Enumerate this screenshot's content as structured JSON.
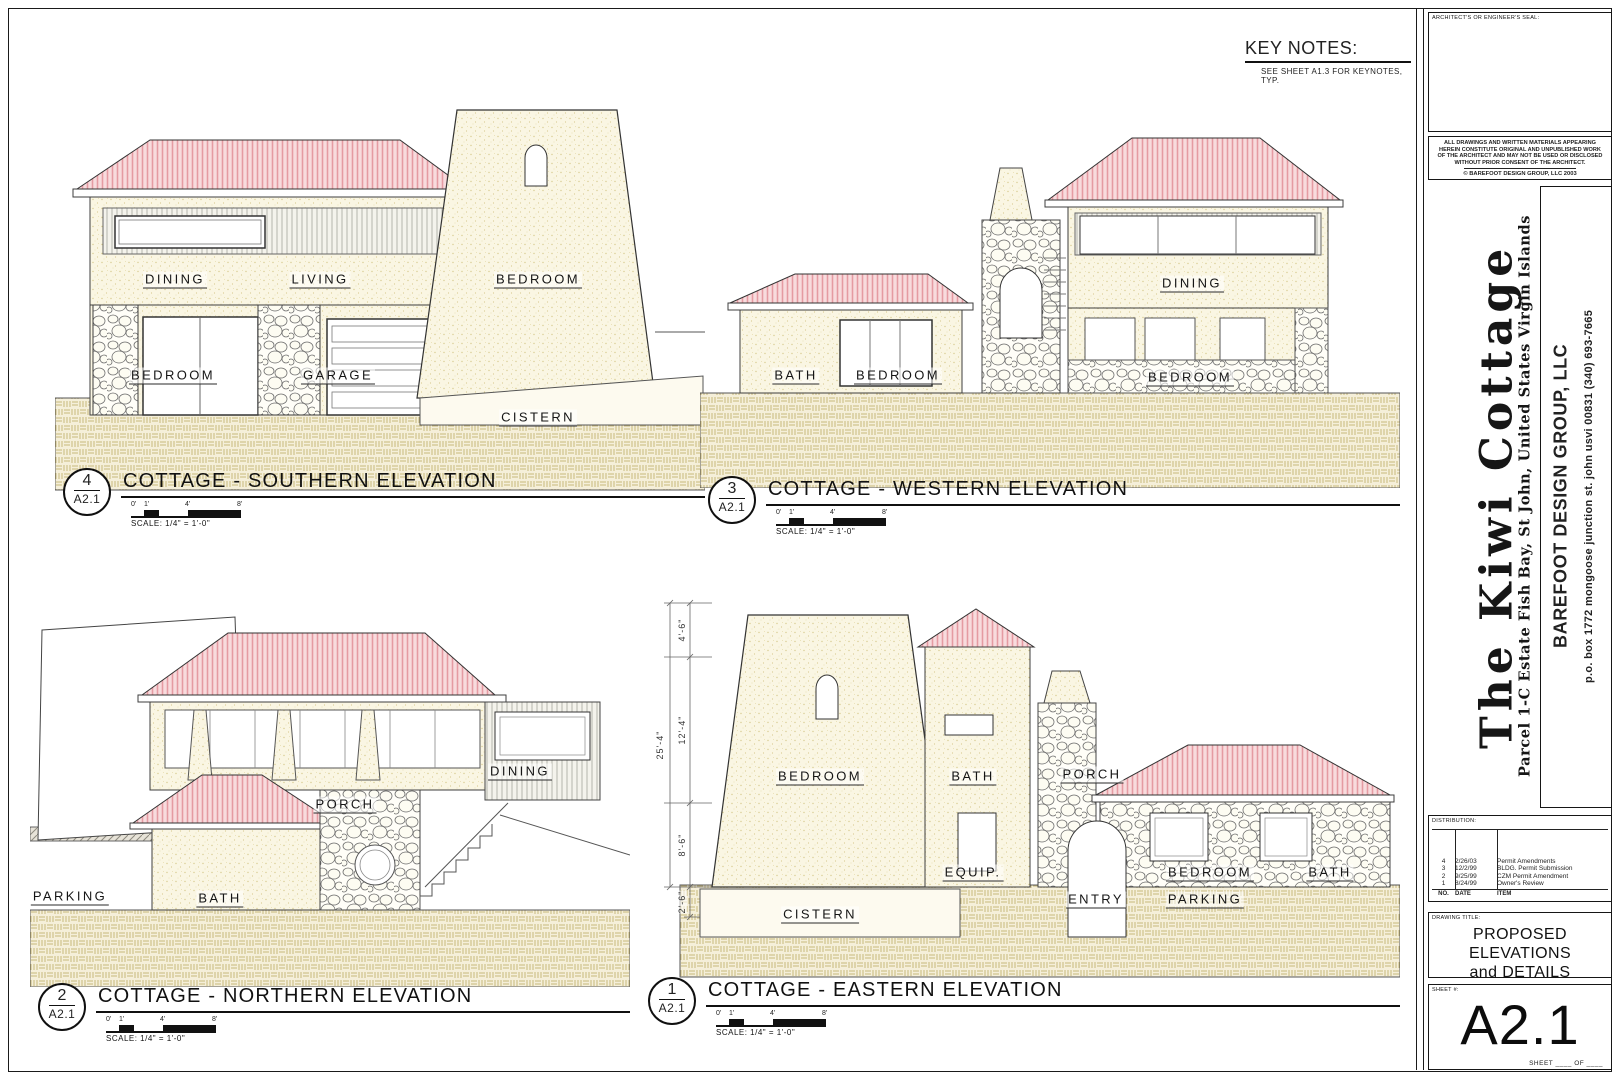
{
  "colors": {
    "roof_pink": "#e59ba2",
    "roof_fill": "#f8dbdd",
    "wall_cream": "#faf6e3",
    "ground_line": "#c8b87c",
    "ground_fill": "#f5efd9",
    "ink": "#333333"
  },
  "key_notes": {
    "title": "KEY NOTES:",
    "note": "SEE SHEET A1.3 FOR KEYNOTES, TYP."
  },
  "elevations": [
    {
      "number": "4",
      "sheet_ref": "A2.1",
      "title": "COTTAGE - SOUTHERN ELEVATION",
      "scale": "SCALE: 1/4\" = 1'-0\"",
      "ticks": [
        "0'",
        "1'",
        "4'",
        "8'"
      ],
      "rooms": [
        "DINING",
        "LIVING",
        "BEDROOM",
        "BEDROOM",
        "GARAGE",
        "CISTERN"
      ]
    },
    {
      "number": "3",
      "sheet_ref": "A2.1",
      "title": "COTTAGE - WESTERN ELEVATION",
      "scale": "SCALE: 1/4\" = 1'-0\"",
      "ticks": [
        "0'",
        "1'",
        "4'",
        "8'"
      ],
      "rooms": [
        "DINING",
        "BATH",
        "BEDROOM",
        "BEDROOM"
      ]
    },
    {
      "number": "2",
      "sheet_ref": "A2.1",
      "title": "COTTAGE - NORTHERN ELEVATION",
      "scale": "SCALE: 1/4\" = 1'-0\"",
      "ticks": [
        "0'",
        "1'",
        "4'",
        "8'"
      ],
      "rooms": [
        "PORCH",
        "DINING",
        "BATH",
        "PARKING"
      ]
    },
    {
      "number": "1",
      "sheet_ref": "A2.1",
      "title": "COTTAGE - EASTERN ELEVATION",
      "scale": "SCALE: 1/4\" = 1'-0\"",
      "ticks": [
        "0'",
        "1'",
        "4'",
        "8'"
      ],
      "rooms": [
        "BEDROOM",
        "BATH",
        "PORCH",
        "EQUIP.",
        "CISTERN",
        "ENTRY",
        "BEDROOM",
        "PARKING",
        "BATH"
      ],
      "dimensions": {
        "overall": "25'-4\"",
        "segments": [
          "4'-6\"",
          "12'-4\"",
          "8'-6\"",
          "2'-6\""
        ]
      }
    }
  ],
  "title_block": {
    "seal_label": "ARCHITECT'S OR ENGINEER'S SEAL:",
    "legal": "ALL DRAWINGS AND WRITTEN MATERIALS APPEARING HEREIN CONSTITUTE ORIGINAL AND UNPUBLISHED WORK OF THE ARCHITECT AND MAY NOT BE USED OR DISCLOSED WITHOUT PRIOR CONSENT OF THE ARCHITECT.",
    "copyright": "© BAREFOOT DESIGN GROUP, LLC 2003",
    "project_title": "The Kiwi Cottage",
    "project_location": "Parcel 1-C Estate Fish Bay, St John, United States Virgin Islands",
    "firm_name": "BAREFOOT DESIGN GROUP, LLC",
    "firm_address": "p.o. box 1772 mongoose junction st. john usvi 00831 (340) 693-7665",
    "distribution": {
      "label": "DISTRIBUTION:",
      "rows": [
        {
          "no": "4",
          "date": "2/26/03",
          "item": "Permit Amendments"
        },
        {
          "no": "3",
          "date": "12/2/99",
          "item": "BLDG. Permit Submission"
        },
        {
          "no": "2",
          "date": "9/25/99",
          "item": "CZM Permit Amendment"
        },
        {
          "no": "1",
          "date": "8/24/99",
          "item": "Owner's Review"
        }
      ],
      "footer": {
        "no": "NO.",
        "date": "DATE",
        "item": "ITEM"
      }
    },
    "drawing_title_label": "DRAWING TITLE:",
    "drawing_title": "PROPOSED ELEVATIONS and DETAILS",
    "sheet_label": "SHEET #:",
    "sheet_number": "A2.1",
    "sheet_of": "SHEET ____ OF ____"
  }
}
